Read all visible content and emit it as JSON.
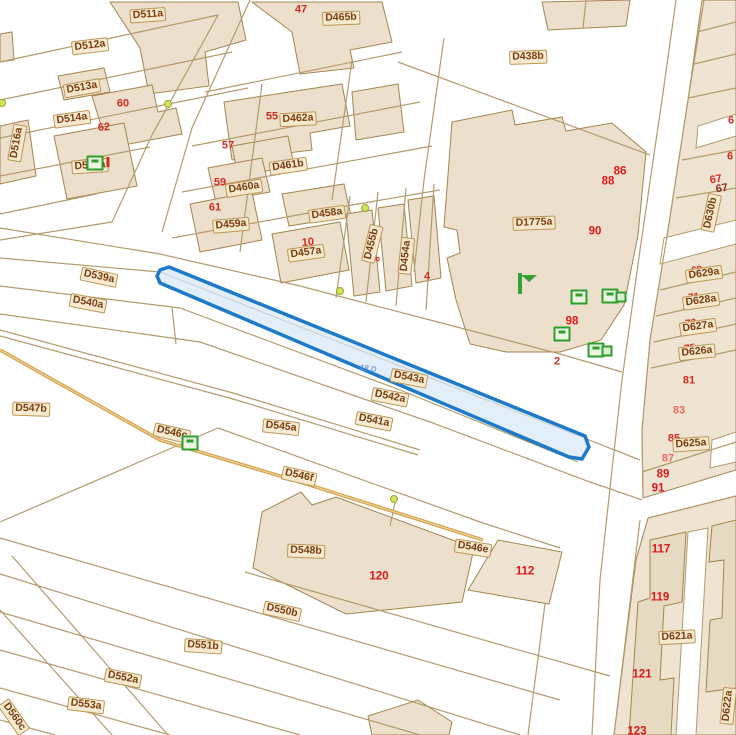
{
  "map": {
    "selected_parcel": {
      "label": "D543a",
      "overlay_text": "18 D"
    },
    "colors": {
      "selection_stroke": "#1d7ac9",
      "selection_fill": "#d7e9f8",
      "parcel_line": "#b39b6e",
      "building_fill": "#ece0cc",
      "building_stroke": "#a5854f",
      "label_text": "#7b3c0e",
      "label_bg": "#f7e9cb",
      "number_red": "#d42b1e",
      "road_tan": "#d4a24b",
      "icon_green": "#2e9e2e",
      "marker_yellow": "#d6e25a"
    },
    "labels": [
      {
        "text": "64",
        "type": "red under",
        "x": 141,
        "y": 14,
        "rot": 0
      },
      {
        "text": "D511a",
        "type": "chip",
        "x": 148,
        "y": 15,
        "rot": -4
      },
      {
        "text": "D512a",
        "type": "chip",
        "x": 90,
        "y": 46,
        "rot": -7
      },
      {
        "text": "D513a",
        "type": "chip",
        "x": 82,
        "y": 88,
        "rot": -10
      },
      {
        "text": "60",
        "type": "red",
        "x": 123,
        "y": 104,
        "rot": 0
      },
      {
        "text": "D514a",
        "type": "chip",
        "x": 72,
        "y": 119,
        "rot": -8
      },
      {
        "text": "62",
        "type": "red",
        "x": 104,
        "y": 128,
        "rot": -4
      },
      {
        "text": "D516a",
        "type": "chip",
        "x": 17,
        "y": 143,
        "rot": -80
      },
      {
        "text": "D515a",
        "type": "chip",
        "x": 90,
        "y": 166,
        "rot": -4
      },
      {
        "text": "47",
        "type": "red",
        "x": 301,
        "y": 10,
        "rot": 0
      },
      {
        "text": "D465b",
        "type": "chip",
        "x": 341,
        "y": 18,
        "rot": -2
      },
      {
        "text": "55",
        "type": "red",
        "x": 272,
        "y": 117,
        "rot": 0
      },
      {
        "text": "D462a",
        "type": "chip",
        "x": 298,
        "y": 119,
        "rot": -3
      },
      {
        "text": "57",
        "type": "red",
        "x": 228,
        "y": 146,
        "rot": 0
      },
      {
        "text": "D461b",
        "type": "chip",
        "x": 288,
        "y": 166,
        "rot": -8
      },
      {
        "text": "59",
        "type": "red",
        "x": 220,
        "y": 183,
        "rot": 0
      },
      {
        "text": "D460a",
        "type": "chip",
        "x": 244,
        "y": 188,
        "rot": -9
      },
      {
        "text": "61",
        "type": "red",
        "x": 215,
        "y": 208,
        "rot": 0
      },
      {
        "text": "D459a",
        "type": "chip",
        "x": 231,
        "y": 225,
        "rot": -5
      },
      {
        "text": "D458a",
        "type": "chip",
        "x": 327,
        "y": 214,
        "rot": -8
      },
      {
        "text": "10",
        "type": "red",
        "x": 308,
        "y": 243,
        "rot": -6
      },
      {
        "text": "D457a",
        "type": "chip",
        "x": 306,
        "y": 253,
        "rot": -8
      },
      {
        "text": "D455b",
        "type": "chip",
        "x": 372,
        "y": 244,
        "rot": -76
      },
      {
        "text": "8",
        "type": "red",
        "x": 377,
        "y": 259,
        "rot": -76,
        "size": 9
      },
      {
        "text": "D454a",
        "type": "chip",
        "x": 406,
        "y": 256,
        "rot": -84
      },
      {
        "text": "4",
        "type": "red",
        "x": 427,
        "y": 277,
        "rot": 0
      },
      {
        "text": "D438b",
        "type": "chip",
        "x": 528,
        "y": 57,
        "rot": -2
      },
      {
        "text": "86",
        "type": "redbold",
        "x": 620,
        "y": 172,
        "rot": 0
      },
      {
        "text": "88",
        "type": "redbold",
        "x": 608,
        "y": 182,
        "rot": 0
      },
      {
        "text": "D1775a",
        "type": "chip",
        "x": 534,
        "y": 223,
        "rot": -2
      },
      {
        "text": "90",
        "type": "redbold",
        "x": 595,
        "y": 232,
        "rot": 0
      },
      {
        "text": "98",
        "type": "redbold",
        "x": 572,
        "y": 322,
        "rot": 0
      },
      {
        "text": "2",
        "type": "red",
        "x": 557,
        "y": 362,
        "rot": 0
      },
      {
        "text": "6",
        "type": "red",
        "x": 731,
        "y": 121,
        "rot": 0
      },
      {
        "text": "6",
        "type": "red",
        "x": 730,
        "y": 157,
        "rot": 0
      },
      {
        "text": "67",
        "type": "red",
        "x": 716,
        "y": 180,
        "rot": -10
      },
      {
        "text": "67",
        "type": "reddark",
        "x": 722,
        "y": 189,
        "rot": -10
      },
      {
        "text": "D630b",
        "type": "chip",
        "x": 711,
        "y": 213,
        "rot": -78
      },
      {
        "text": "69",
        "type": "red under",
        "x": 697,
        "y": 271,
        "rot": -8,
        "size": 10
      },
      {
        "text": "D629a",
        "type": "chip",
        "x": 704,
        "y": 274,
        "rot": -8
      },
      {
        "text": "71",
        "type": "red under",
        "x": 694,
        "y": 298,
        "rot": -8,
        "size": 10
      },
      {
        "text": "D628a",
        "type": "chip",
        "x": 701,
        "y": 301,
        "rot": -8
      },
      {
        "text": "73",
        "type": "red under",
        "x": 691,
        "y": 324,
        "rot": -8,
        "size": 10
      },
      {
        "text": "D627a",
        "type": "chip",
        "x": 698,
        "y": 327,
        "rot": -8
      },
      {
        "text": "75",
        "type": "red under",
        "x": 690,
        "y": 349,
        "rot": -8,
        "size": 10
      },
      {
        "text": "D626a",
        "type": "chip",
        "x": 697,
        "y": 352,
        "rot": -6
      },
      {
        "text": "81",
        "type": "red",
        "x": 689,
        "y": 381,
        "rot": 0
      },
      {
        "text": "83",
        "type": "redlight",
        "x": 679,
        "y": 411,
        "rot": 0
      },
      {
        "text": "85",
        "type": "red",
        "x": 674,
        "y": 439,
        "rot": 0
      },
      {
        "text": "D625a",
        "type": "chip",
        "x": 691,
        "y": 444,
        "rot": -4
      },
      {
        "text": "87",
        "type": "redlight",
        "x": 668,
        "y": 459,
        "rot": 0
      },
      {
        "text": "89",
        "type": "redbold",
        "x": 663,
        "y": 475,
        "rot": 0
      },
      {
        "text": "91",
        "type": "redbold",
        "x": 658,
        "y": 489,
        "rot": 0
      },
      {
        "text": "D539a",
        "type": "chip",
        "x": 99,
        "y": 277,
        "rot": 12
      },
      {
        "text": "D540a",
        "type": "chip",
        "x": 88,
        "y": 303,
        "rot": 11
      },
      {
        "text": "18 D",
        "type": "blue",
        "x": 368,
        "y": 369,
        "rot": 8
      },
      {
        "text": "D543a",
        "type": "chip",
        "x": 409,
        "y": 378,
        "rot": 11
      },
      {
        "text": "D542a",
        "type": "chip",
        "x": 390,
        "y": 397,
        "rot": 11
      },
      {
        "text": "D541a",
        "type": "chip",
        "x": 374,
        "y": 421,
        "rot": 11
      },
      {
        "text": "D545a",
        "type": "chip",
        "x": 281,
        "y": 427,
        "rot": 6
      },
      {
        "text": "D547b",
        "type": "chip",
        "x": 31,
        "y": 409,
        "rot": 2
      },
      {
        "text": "D546c",
        "type": "chip",
        "x": 172,
        "y": 433,
        "rot": 13
      },
      {
        "text": "D546f",
        "type": "chip",
        "x": 299,
        "y": 476,
        "rot": 13
      },
      {
        "text": "D548b",
        "type": "chip",
        "x": 306,
        "y": 551,
        "rot": 2
      },
      {
        "text": "120",
        "type": "redbold",
        "x": 379,
        "y": 577,
        "rot": 0
      },
      {
        "text": "D546e",
        "type": "chip",
        "x": 473,
        "y": 548,
        "rot": 9
      },
      {
        "text": "112",
        "type": "redbold",
        "x": 525,
        "y": 572,
        "rot": 0
      },
      {
        "text": "D550b",
        "type": "chip",
        "x": 282,
        "y": 611,
        "rot": 12
      },
      {
        "text": "D551b",
        "type": "chip",
        "x": 203,
        "y": 646,
        "rot": 4
      },
      {
        "text": "D552a",
        "type": "chip",
        "x": 123,
        "y": 678,
        "rot": 11
      },
      {
        "text": "D553a",
        "type": "chip",
        "x": 86,
        "y": 705,
        "rot": 7
      },
      {
        "text": "D560c",
        "type": "chip",
        "x": 14,
        "y": 717,
        "rot": 55
      },
      {
        "text": "117",
        "type": "redbold",
        "x": 661,
        "y": 550,
        "rot": 0
      },
      {
        "text": "119",
        "type": "redbold",
        "x": 660,
        "y": 598,
        "rot": 0
      },
      {
        "text": "D621a",
        "type": "chip",
        "x": 677,
        "y": 637,
        "rot": -3
      },
      {
        "text": "121",
        "type": "redbold",
        "x": 642,
        "y": 675,
        "rot": 0
      },
      {
        "text": "123",
        "type": "redbold",
        "x": 637,
        "y": 732,
        "rot": 0
      },
      {
        "text": "D622a",
        "type": "chip",
        "x": 728,
        "y": 706,
        "rot": -84
      }
    ],
    "icons": [
      {
        "type": "house-icon",
        "x": 95,
        "y": 163
      },
      {
        "type": "red-tick-icon",
        "x": 108,
        "y": 162
      },
      {
        "type": "house-icon",
        "x": 190,
        "y": 443
      },
      {
        "type": "envelope-icon",
        "x": 518,
        "y": 275
      },
      {
        "type": "house-icon",
        "x": 579,
        "y": 297
      },
      {
        "type": "house-icon",
        "x": 610,
        "y": 296
      },
      {
        "type": "box-icon",
        "x": 621,
        "y": 297
      },
      {
        "type": "house-icon",
        "x": 562,
        "y": 334
      },
      {
        "type": "house-icon",
        "x": 596,
        "y": 350
      },
      {
        "type": "box-icon",
        "x": 607,
        "y": 351
      },
      {
        "type": "dot-icon",
        "x": 2,
        "y": 103
      },
      {
        "type": "dot-icon",
        "x": 168,
        "y": 104
      },
      {
        "type": "dot-icon",
        "x": 365,
        "y": 208
      },
      {
        "type": "dot-icon",
        "x": 340,
        "y": 291
      },
      {
        "type": "dot-icon",
        "x": 394,
        "y": 499
      }
    ]
  }
}
